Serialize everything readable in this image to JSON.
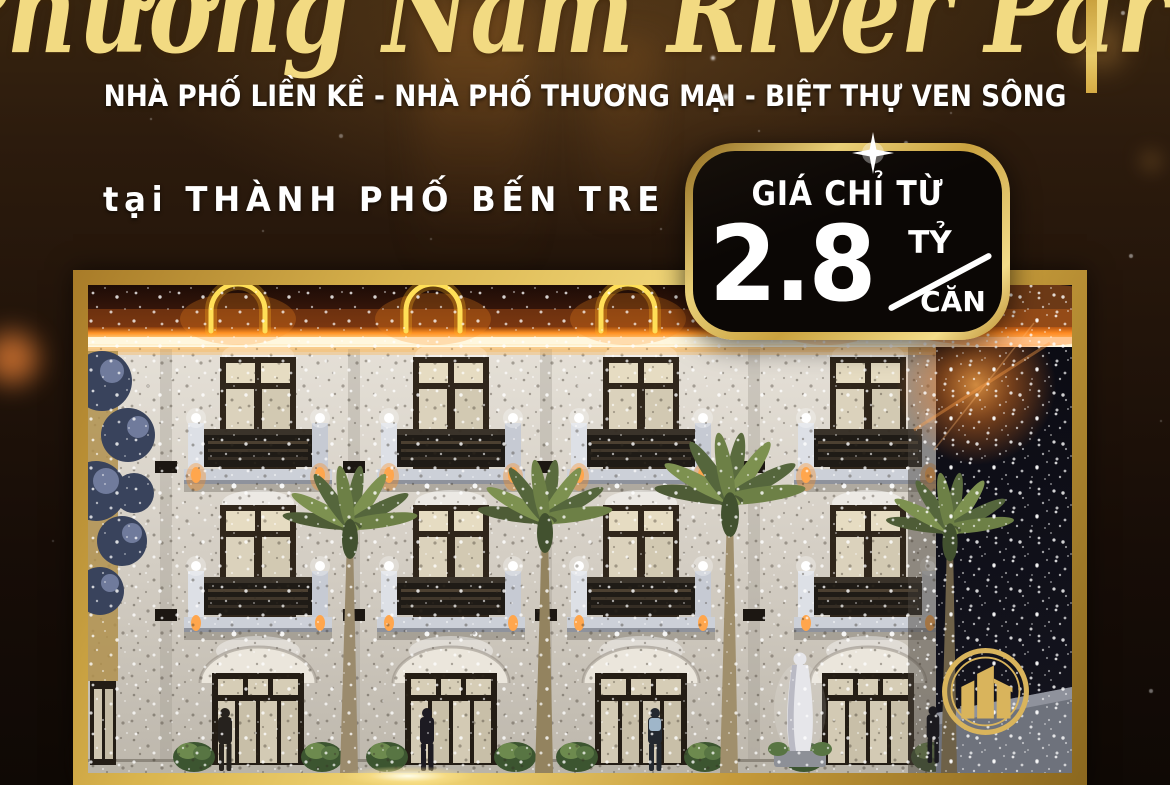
{
  "poster": {
    "title": "Phương Nam River Park",
    "subtitle": "NHÀ PHỐ LIỀN KỀ - NHÀ PHỐ THƯƠNG MẠI - BIỆT THỰ VEN SÔNG",
    "location_line": "tại THÀNH PHỐ BẾN TRE",
    "price_badge": {
      "label": "GIÁ CHỈ TỪ",
      "amount": "2.8",
      "unit_top": "TỶ",
      "unit_bottom": "CĂN"
    },
    "icons": {
      "logo": "gold-buildings-emblem",
      "badge_sparkle": "four-point-star"
    },
    "colors": {
      "title_gold": "#f2da82",
      "frame_gold": "#c79b3a",
      "badge_background": "#0b0705",
      "text_white": "#ffffff",
      "neon_yellow": "#ffdf57",
      "background_brown": "#22140a"
    }
  }
}
